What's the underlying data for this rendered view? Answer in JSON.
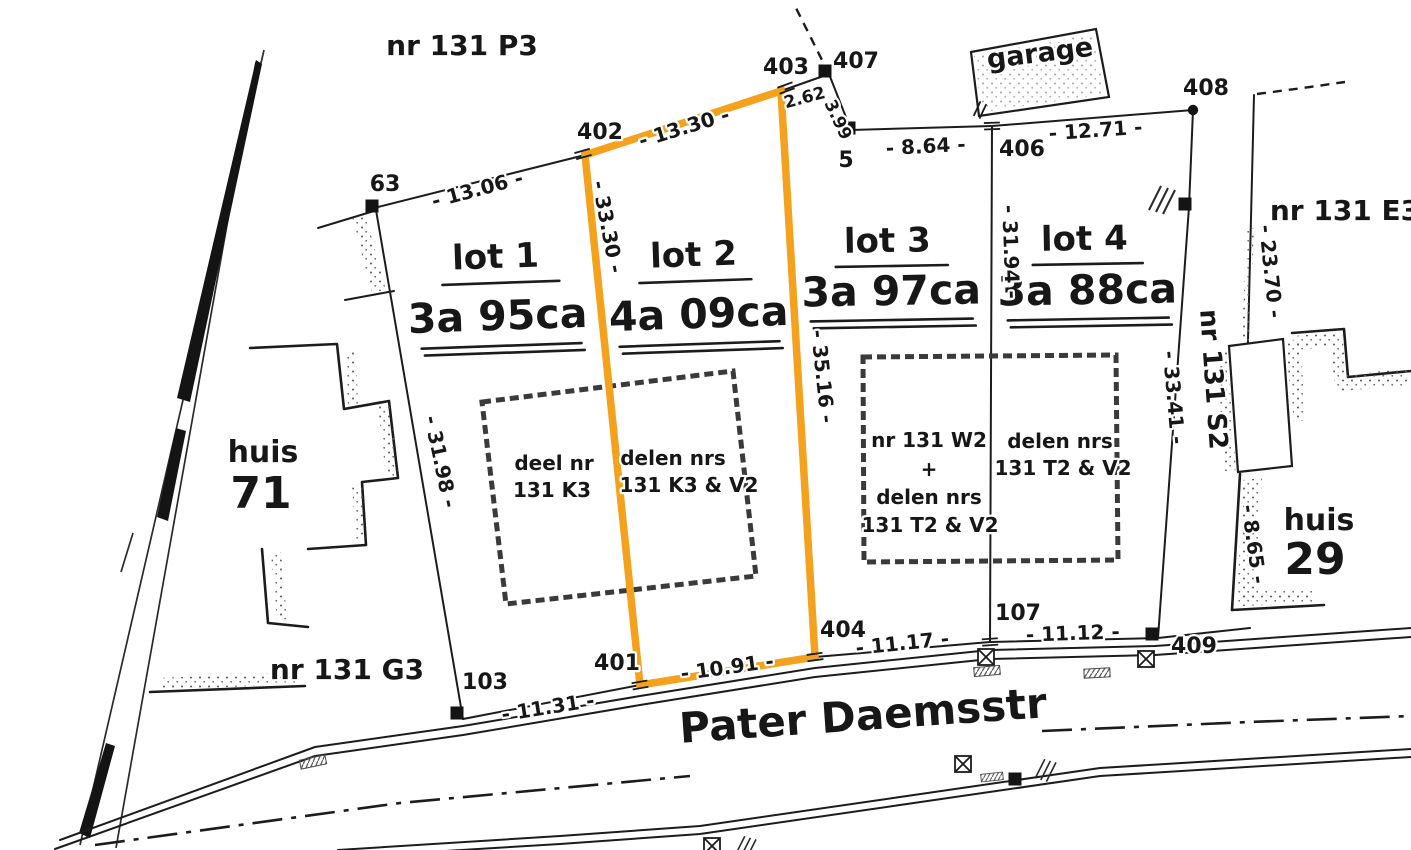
{
  "colors": {
    "highlight": "#F4A11D",
    "ink": "#1c1c1c"
  },
  "parcels": {
    "top": "nr 131 P3",
    "right": "nr 131 E3",
    "bottom_left": "nr 131 G3",
    "right_edge": "nr 131 S2"
  },
  "street": {
    "name": "Pater Daemsstr"
  },
  "garage": {
    "label": "garage"
  },
  "houses": {
    "huis71": {
      "word": "huis",
      "number": "71"
    },
    "huis29": {
      "word": "huis",
      "number": "29"
    }
  },
  "lots": {
    "lot1": {
      "name": "lot 1",
      "area": "3a 95ca"
    },
    "lot2": {
      "name": "lot 2",
      "area": "4a 09ca",
      "highlighted": true
    },
    "lot3": {
      "name": "lot 3",
      "area": "3a 97ca"
    },
    "lot4": {
      "name": "lot 4",
      "area": "3a 88ca"
    }
  },
  "envelopes": {
    "box1": {
      "left_line1": "deel nr",
      "left_line2": "131 K3",
      "right_line1": "delen nrs",
      "right_line2": "131 K3 & V2"
    },
    "box2": {
      "left_line1": "nr 131 W2",
      "left_line2": "+",
      "left_line3": "delen nrs",
      "left_line4": "131 T2 & V2",
      "right_line1": "delen nrs",
      "right_line2": "131 T2 & V2"
    }
  },
  "points": {
    "p5": "5",
    "p63": "63",
    "p103": "103",
    "p107": "107",
    "p401": "401",
    "p402": "402",
    "p403": "403",
    "p404": "404",
    "p406": "406",
    "p407": "407",
    "p408": "408",
    "p409": "409"
  },
  "measurements": {
    "m13_06": "- 13.06 -",
    "m13_30": "- 13.30 -",
    "m2_62": "2.62",
    "m3_99": "3.99",
    "m8_64": "- 8.64 -",
    "m12_71": "- 12.71 -",
    "m33_30": "- 33.30 -",
    "m35_16": "- 35.16 -",
    "m31_94": "- 31.94 -",
    "m33_41": "- 33.41 -",
    "m23_70": "- 23.70 -",
    "m31_98": "- 31.98 -",
    "m8_65": "- 8.65 -",
    "m11_31": "- 11.31 -",
    "m10_91": "- 10.91 -",
    "m11_17": "- 11.17 -",
    "m11_12": "- 11.12 -"
  }
}
